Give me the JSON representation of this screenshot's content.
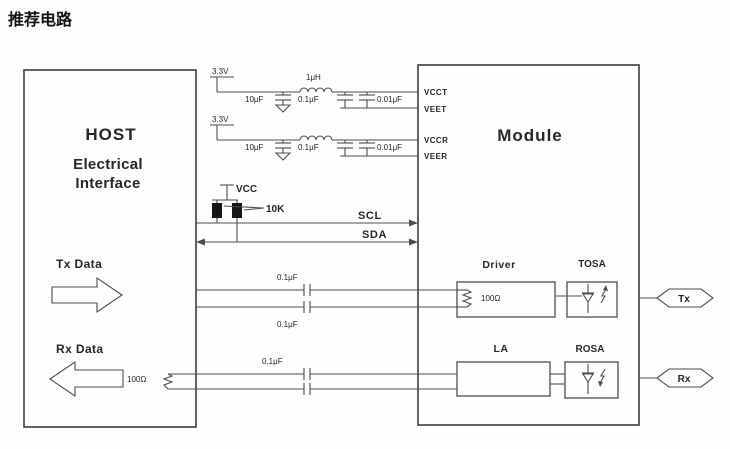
{
  "title": "推荐电路",
  "colors": {
    "line": "#4d4d4d",
    "text": "#262626",
    "background": "#fefefe"
  },
  "host": {
    "title": "HOST",
    "subtitle_line1": "Electrical",
    "subtitle_line2": "Interface",
    "tx_label": "Tx Data",
    "rx_label": "Rx Data",
    "rx_termination": "100Ω"
  },
  "module": {
    "title": "Module",
    "pins": {
      "vcct": "VCCT",
      "veet": "VEET",
      "vccr": "VCCR",
      "veer": "VEER"
    },
    "driver_label": "Driver",
    "driver_termination": "100Ω",
    "tosa_label": "TOSA",
    "la_label": "LA",
    "rosa_label": "ROSA"
  },
  "tx_power_filter": {
    "supply": "3.3V",
    "bulk_cap": "10μF",
    "inductor": "1μH",
    "cap1": "0.1μF",
    "cap2": "0.01μF"
  },
  "rx_power_filter": {
    "supply": "3.3V",
    "bulk_cap": "10μF",
    "cap1": "0.1μF",
    "cap2": "0.01μF"
  },
  "i2c": {
    "pullup_supply": "VCC",
    "pullup_value": "10K",
    "scl_label": "SCL",
    "sda_label": "SDA"
  },
  "ac_coupling": {
    "tx_cap_top": "0.1μF",
    "tx_cap_bottom": "0.1μF",
    "rx_cap": "0.1μF"
  },
  "connectors": {
    "tx": "Tx",
    "rx": "Rx"
  }
}
